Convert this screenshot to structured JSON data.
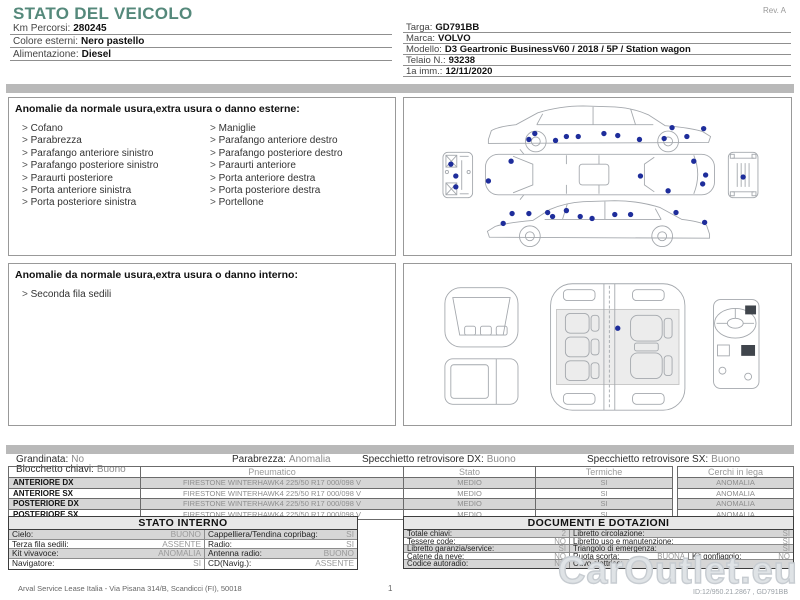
{
  "header": {
    "title": "STATO DEL VEICOLO",
    "rev": "Rev. A",
    "left_rows": [
      {
        "label": "Km Percorsi:",
        "value": "280245"
      },
      {
        "label": "Colore esterni:",
        "value": "Nero pastello"
      },
      {
        "label": "Alimentazione:",
        "value": "Diesel"
      }
    ],
    "right_rows": [
      {
        "label": "Targa:",
        "value": "GD791BB"
      },
      {
        "label": "Marca:",
        "value": "VOLVO"
      },
      {
        "label": "Modello:",
        "value": "D3 Geartronic BusinessV60 / 2018 / 5P / Station wagon"
      },
      {
        "label": "Telaio N.:",
        "value": "93238"
      },
      {
        "label": "1a imm.:",
        "value": "12/11/2020"
      }
    ]
  },
  "exterior_anomalies": {
    "title": "Anomalie da normale usura,extra usura o danno esterne:",
    "col1": [
      "Cofano",
      "Parabrezza",
      "Parafango anteriore sinistro",
      "Parafango posteriore sinistro",
      "Paraurti posteriore",
      "Porta anteriore sinistra",
      "Porta posteriore sinistra"
    ],
    "col2": [
      "Maniglie",
      "Parafango anteriore destro",
      "Parafango posteriore destro",
      "Paraurti anteriore",
      "Porta anteriore destra",
      "Porta posteriore destra",
      "Portellone"
    ]
  },
  "interior_anomalies": {
    "title": "Anomalie da normale usura,extra usura o danno interno:",
    "items": [
      "Seconda fila sedili"
    ]
  },
  "status_row": [
    {
      "label": "Grandinata:",
      "value": "No"
    },
    {
      "label": "Blocchetto chiavi:",
      "value": "Buono"
    },
    {
      "label": "Parabrezza:",
      "value": "Anomalia"
    },
    {
      "label": "Specchietto retrovisore DX:",
      "value": "Buono"
    },
    {
      "label": "Specchietto retrovisore SX:",
      "value": "Buono"
    }
  ],
  "tires": {
    "col_headers": {
      "pneumatico": "Pneumatico",
      "stato": "Stato",
      "termiche": "Termiche",
      "cerchi": "Cerchi in lega"
    },
    "rows": [
      {
        "position": "ANTERIORE DX",
        "tire": "FIRESTONE WINTERHAWK4 225/50 R17 000/098 V",
        "stato": "MEDIO",
        "termiche": "SI",
        "cerchi": "ANOMALIA"
      },
      {
        "position": "ANTERIORE SX",
        "tire": "FIRESTONE WINTERHAWK4 225/50 R17 000/098 V",
        "stato": "MEDIO",
        "termiche": "SI",
        "cerchi": "ANOMALIA"
      },
      {
        "position": "POSTERIORE DX",
        "tire": "FIRESTONE WINTERHAWK4 225/50 R17 000/098 V",
        "stato": "MEDIO",
        "termiche": "SI",
        "cerchi": "ANOMALIA"
      },
      {
        "position": "POSTERIORE SX",
        "tire": "FIRESTONE WINTERHAWK4 225/50 R17 000/098 V",
        "stato": "MEDIO",
        "termiche": "SI",
        "cerchi": "ANOMALIA"
      }
    ]
  },
  "stato_interno": {
    "title": "STATO INTERNO",
    "rows": [
      {
        "l1": "Cielo:",
        "v1": "BUONO",
        "l2": "Cappelliera/Tendina copribag:",
        "v2": "SI"
      },
      {
        "l1": "Terza fila sedili:",
        "v1": "ASSENTE",
        "l2": "Radio:",
        "v2": "SI"
      },
      {
        "l1": "Kit vivavoce:",
        "v1": "ANOMALIA",
        "l2": "Antenna radio:",
        "v2": "BUONO"
      },
      {
        "l1": "Navigatore:",
        "v1": "SI",
        "l2": "CD(Navig.):",
        "v2": "ASSENTE"
      }
    ]
  },
  "documenti": {
    "title": "DOCUMENTI E DOTAZIONI",
    "rows": [
      {
        "l1": "Totale chiavi:",
        "v1": "2",
        "l2": "Libretto circolazione:",
        "v2": "SI"
      },
      {
        "l1": "Tessere code:",
        "v1": "NO",
        "l2": "Libretto uso e manutenzione:",
        "v2": "SI"
      },
      {
        "l1": "Libretto garanzia/service:",
        "v1": "SI",
        "l2": "Triangolo di emergenza:",
        "v2": "SI"
      },
      {
        "l1": "Catene da neve:",
        "v1": "NO",
        "l2": "Ruota scorta:",
        "v2": "BUONA",
        "l3": "Kit gonfiaggio:",
        "v3": "NO"
      },
      {
        "l1": "Codice autoradio:",
        "v1": "NO",
        "l2": "Cavo elettrico:",
        "v2": ""
      }
    ]
  },
  "footer": {
    "address": "Arval Service Lease Italia - Via Pisana 314/B, Scandicci (FI), 50018",
    "page": "1",
    "id_text": "ID:12/950.21.2867 , GD791BB",
    "watermark": "CarOutlet.eu"
  },
  "diagrams": {
    "dot_color": "#1e2d9b",
    "exterior_points": [
      [
        125,
        42
      ],
      [
        131,
        36
      ],
      [
        152,
        43
      ],
      [
        163,
        39
      ],
      [
        175,
        39
      ],
      [
        201,
        36
      ],
      [
        215,
        38
      ],
      [
        237,
        42
      ],
      [
        262,
        41
      ],
      [
        270,
        30
      ],
      [
        285,
        39
      ],
      [
        302,
        31
      ],
      [
        107,
        64
      ],
      [
        84,
        84
      ],
      [
        238,
        79
      ],
      [
        292,
        64
      ],
      [
        304,
        78
      ],
      [
        301,
        87
      ],
      [
        266,
        94
      ],
      [
        46,
        67
      ],
      [
        51,
        79
      ],
      [
        51,
        90
      ],
      [
        342,
        80
      ],
      [
        99,
        127
      ],
      [
        108,
        117
      ],
      [
        125,
        117
      ],
      [
        144,
        116
      ],
      [
        149,
        120
      ],
      [
        163,
        114
      ],
      [
        177,
        120
      ],
      [
        189,
        122
      ],
      [
        212,
        118
      ],
      [
        228,
        118
      ],
      [
        274,
        116
      ],
      [
        303,
        126
      ]
    ],
    "interior_points": [
      [
        215,
        65
      ]
    ]
  }
}
